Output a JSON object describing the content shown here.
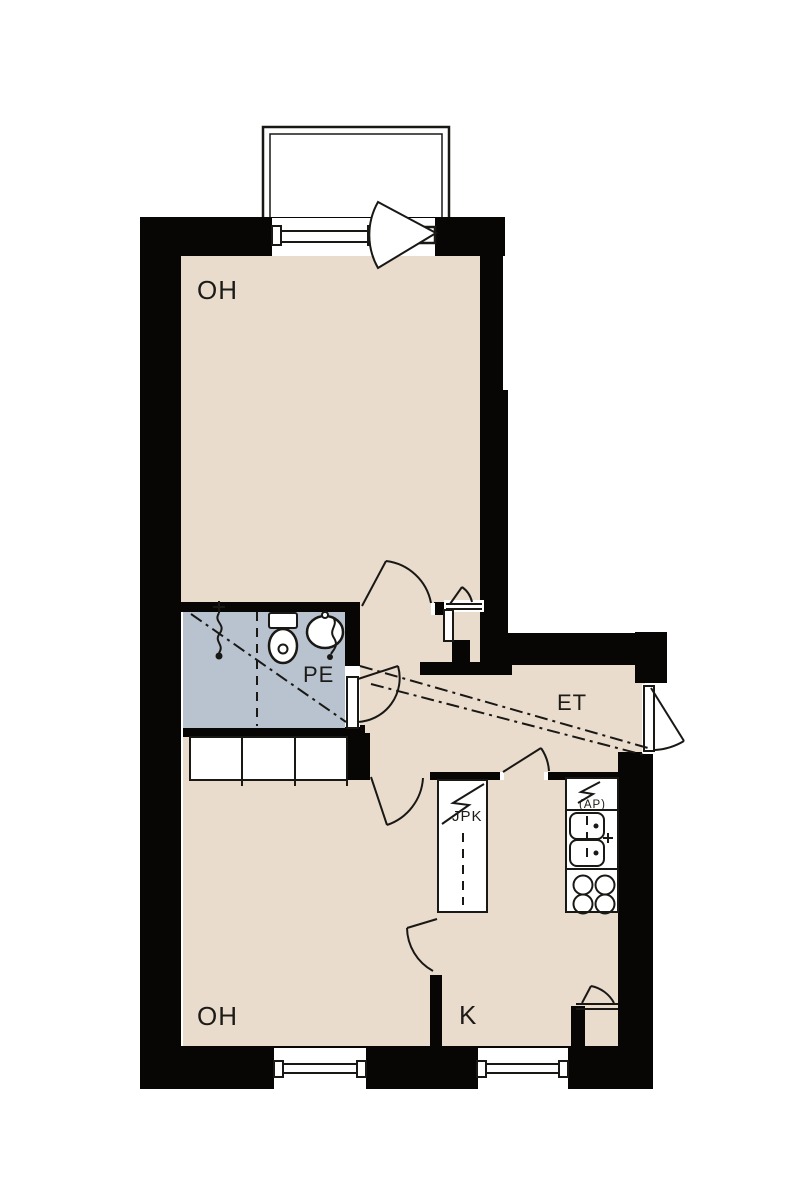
{
  "plan": {
    "type": "apartment-floor-plan",
    "colors": {
      "wall": "#070605",
      "floor": "#e9dccd",
      "wet-floor": "#b8c3cf",
      "line": "#191815",
      "bg": "#ffffff",
      "text": "#1d1b18"
    },
    "rooms": [
      {
        "id": "living-room-top",
        "label": "OH"
      },
      {
        "id": "bathroom",
        "label": "PE"
      },
      {
        "id": "entry-hall",
        "label": "ET"
      },
      {
        "id": "kitchen",
        "label": "K"
      },
      {
        "id": "living-room-bottom",
        "label": "OH"
      }
    ],
    "appliances": [
      {
        "id": "fridge-freezer-unit",
        "label": "JPK"
      },
      {
        "id": "dishwasher-space",
        "label": "(AP)"
      }
    ]
  }
}
